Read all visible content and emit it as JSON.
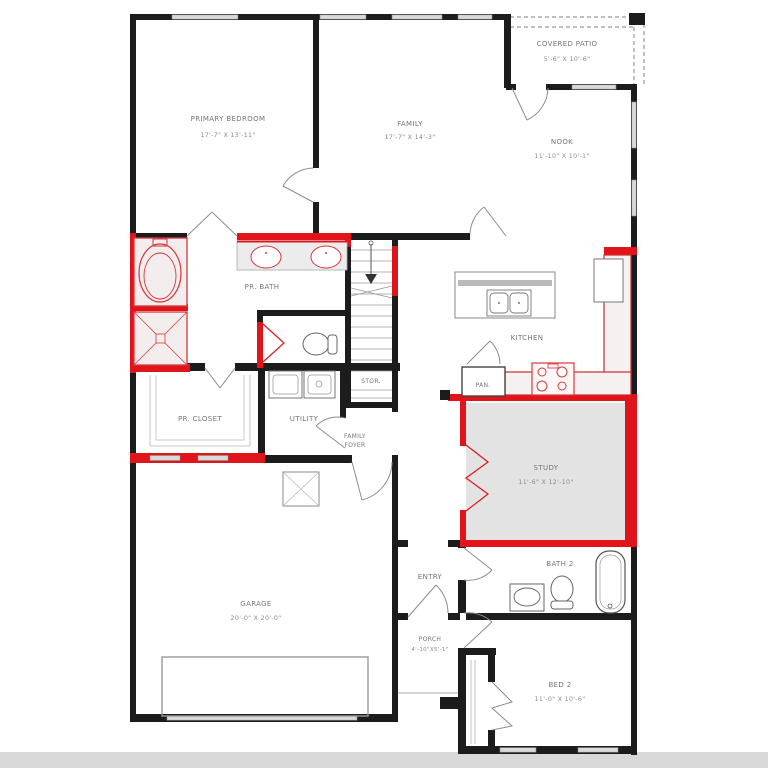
{
  "plan": {
    "type": "single-story floor plan",
    "colors": {
      "wall": "#1c1c1c",
      "highlight_red": "#e0151b",
      "window_gray": "#d9d9d9",
      "room_fill_gray": "#e3e3e3",
      "fixture_fill": "#f3eded",
      "thin_line": "#999999",
      "footer_bar": "#d9d9d9"
    },
    "rooms": {
      "primary_bedroom": {
        "name": "PRIMARY BEDROOM",
        "dims": "17'-7\" X 13'-11\""
      },
      "family": {
        "name": "FAMILY",
        "dims": "17'-7\" X 14'-3\""
      },
      "covered_patio": {
        "name": "COVERED PATIO",
        "dims": "5'-6\" X 10'-6\""
      },
      "nook": {
        "name": "NOOK",
        "dims": "11'-10\" X 10'-1\""
      },
      "pr_bath": {
        "name": "PR. BATH"
      },
      "kitchen": {
        "name": "KITCHEN"
      },
      "stor": {
        "name": "STOR."
      },
      "pan": {
        "name": "PAN."
      },
      "study": {
        "name": "STUDY",
        "dims": "11'-6\" X 12'-10\""
      },
      "pr_closet": {
        "name": "PR. CLOSET"
      },
      "utility": {
        "name": "UTILITY"
      },
      "family_foyer": {
        "line1": "FAMILY",
        "line2": "FOYER"
      },
      "garage": {
        "name": "GARAGE",
        "dims": "20'-0\" X 20'-0\""
      },
      "entry": {
        "name": "ENTRY"
      },
      "bath_2": {
        "name": "BATH 2"
      },
      "porch": {
        "name": "PORCH",
        "dims": "4'-10\"X5'-1\""
      },
      "bed_2": {
        "name": "BED 2",
        "dims": "11'-0\" X 10'-6\""
      }
    },
    "fixtures": [
      "tub",
      "shower",
      "double-vanity",
      "toilet",
      "stairs-up",
      "kitchen-island-double-sink",
      "range",
      "refrigerator",
      "pantry",
      "washer-dryer",
      "bath2-sink",
      "bath2-toilet",
      "bath2-tub",
      "closet-rods",
      "garage-door",
      "attic-box"
    ],
    "highlighted_option_areas": [
      "primary bath tub/shower",
      "vanity wall",
      "study",
      "kitchen counters/range",
      "closet wall"
    ]
  }
}
